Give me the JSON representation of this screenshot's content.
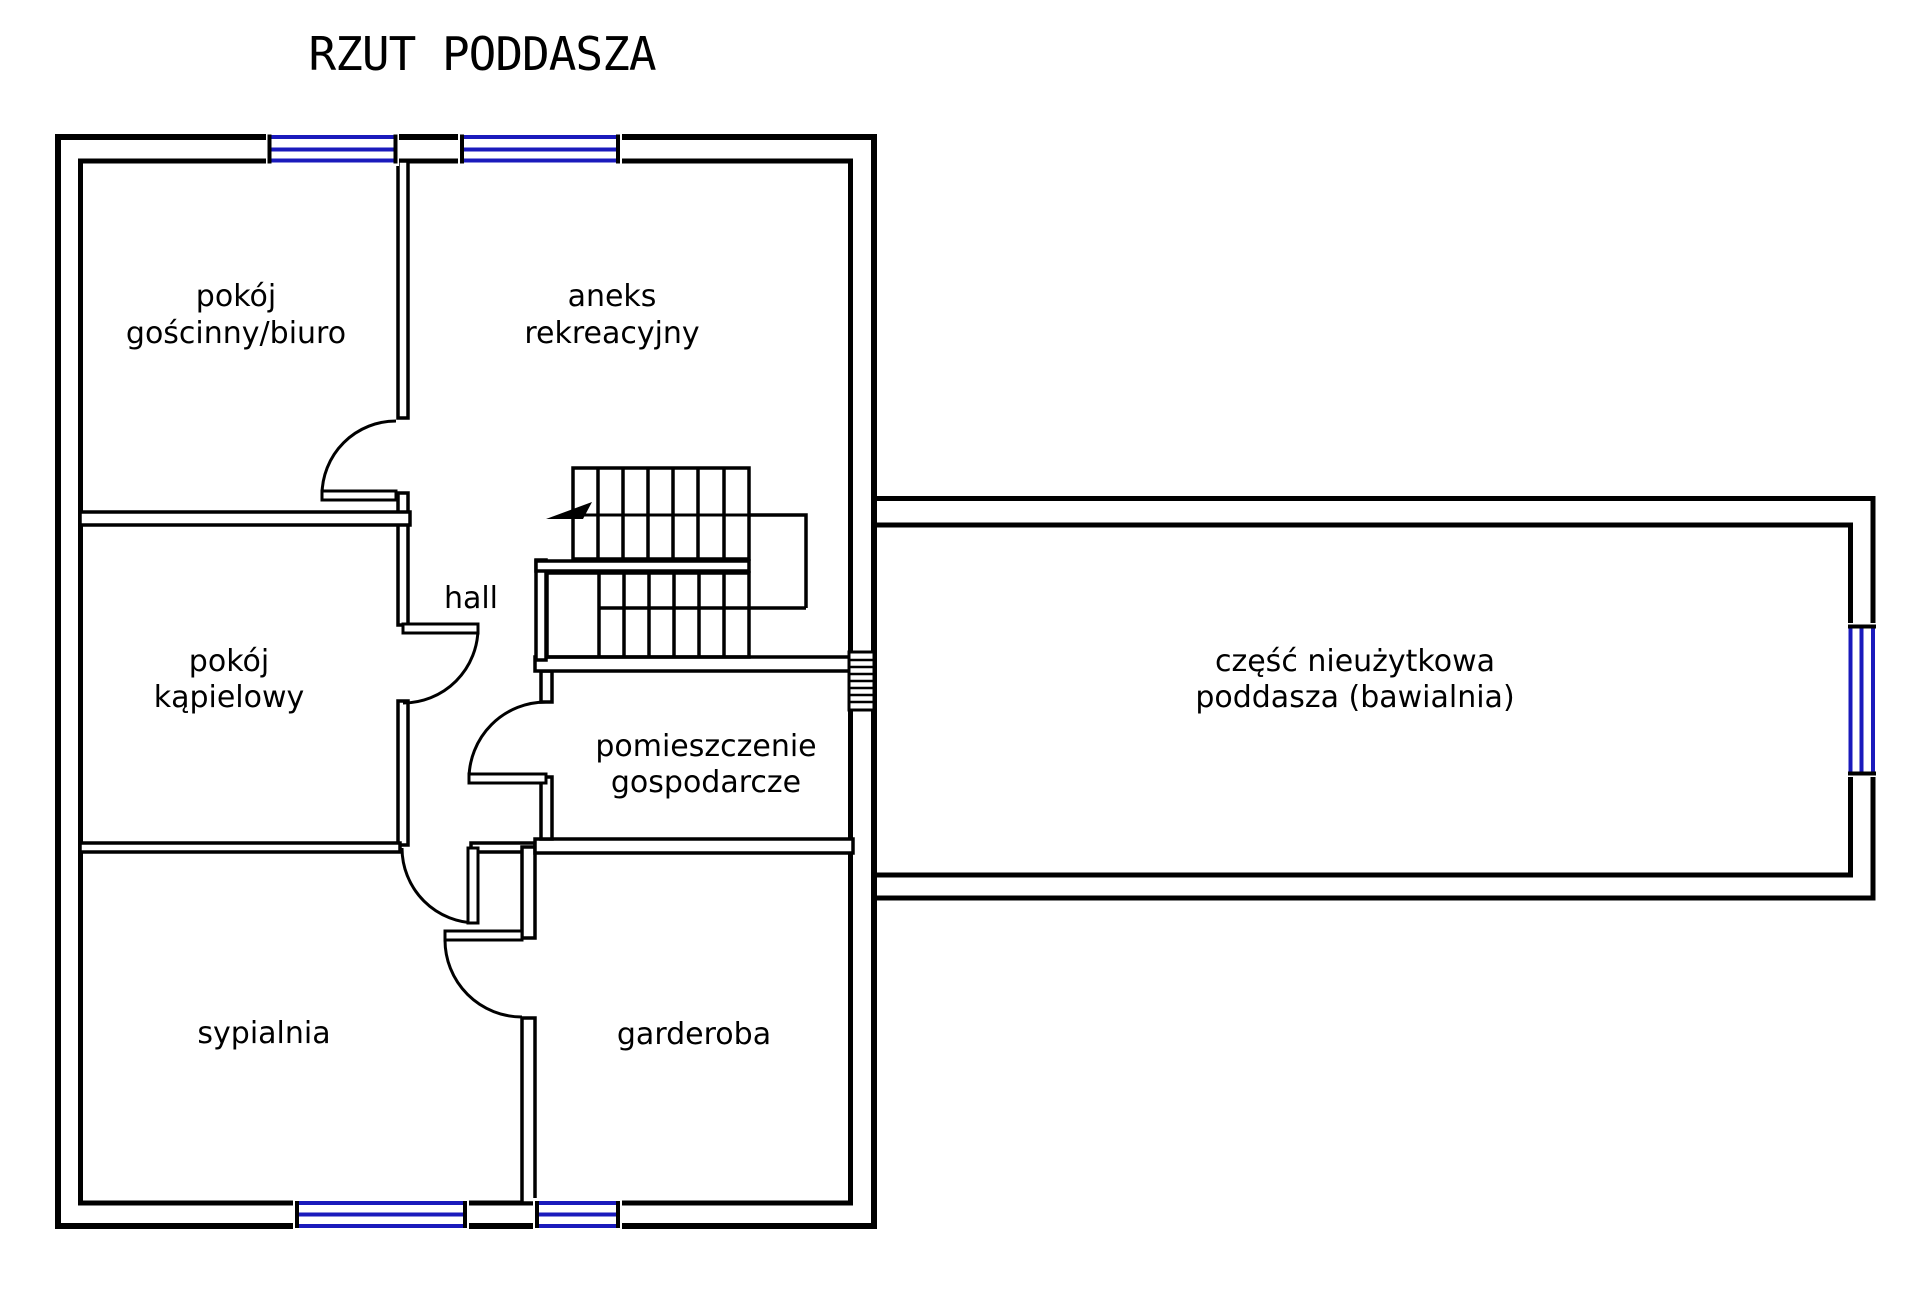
{
  "title": "RZUT PODDASZA",
  "colors": {
    "walls": "#000000",
    "windows": "#1a1abc",
    "background": "#ffffff"
  },
  "rooms": {
    "guest": {
      "line1": "pokój",
      "line2": "gościnny/biuro"
    },
    "annex": {
      "line1": "aneks",
      "line2": "rekreacyjny"
    },
    "hall": {
      "label": "hall"
    },
    "bath": {
      "line1": "pokój",
      "line2": "kąpielowy"
    },
    "utility": {
      "line1": "pomieszczenie",
      "line2": "gospodarcze"
    },
    "bedroom": {
      "label": "sypialnia"
    },
    "wardrobe": {
      "label": "garderoba"
    },
    "attic": {
      "line1": "część nieużytkowa",
      "line2": "poddasza (bawialnia)"
    }
  }
}
